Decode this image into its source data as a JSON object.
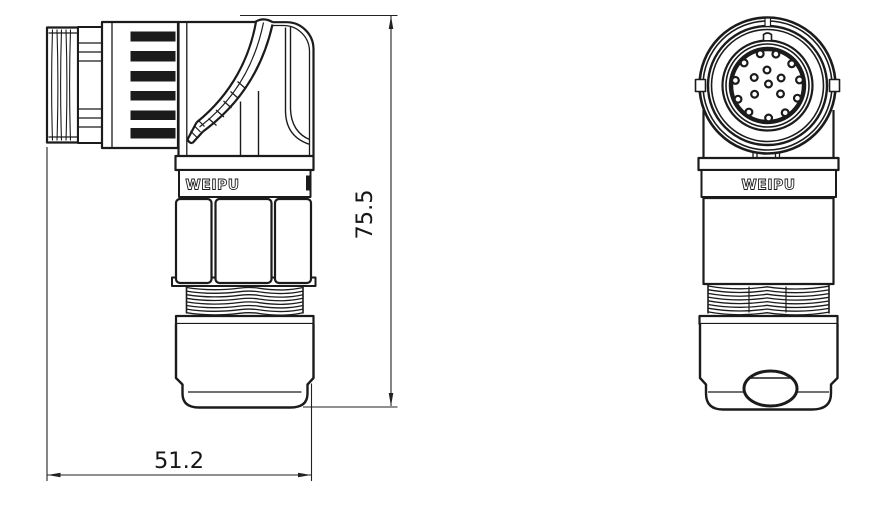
{
  "drawing_title": "right-angle circular connector, two-view dimensioned drawing",
  "brand": "WEIPU",
  "colors": {
    "line": "#1b1b1b",
    "dimension": "#222222",
    "background": "#ffffff"
  },
  "dimensions": {
    "height": {
      "label": "75.5"
    },
    "width": {
      "label": "51.2"
    }
  },
  "side_view": {
    "logo": "WEIPU"
  },
  "front_view": {
    "logo": "WEIPU",
    "face": {
      "center": [
        767.5,
        85.5
      ],
      "ring_radii": [
        68,
        64.5,
        59.5,
        56,
        45,
        41.5
      ],
      "insert_radius": 36.5,
      "pin_radius": 3.4,
      "pin_total": 17,
      "pins": {
        "rings": [
          {
            "radius": 32.5,
            "bearings_deg": [
              347,
              15,
              48,
              80,
              113,
              147,
              178,
              215,
              245,
              279,
              314
            ]
          },
          {
            "radius": 15.5,
            "bearings_deg": [
              358,
              61,
              123,
              236,
              301
            ]
          }
        ],
        "center_offsets": [
          [
            1,
            -1.5
          ]
        ]
      }
    }
  }
}
